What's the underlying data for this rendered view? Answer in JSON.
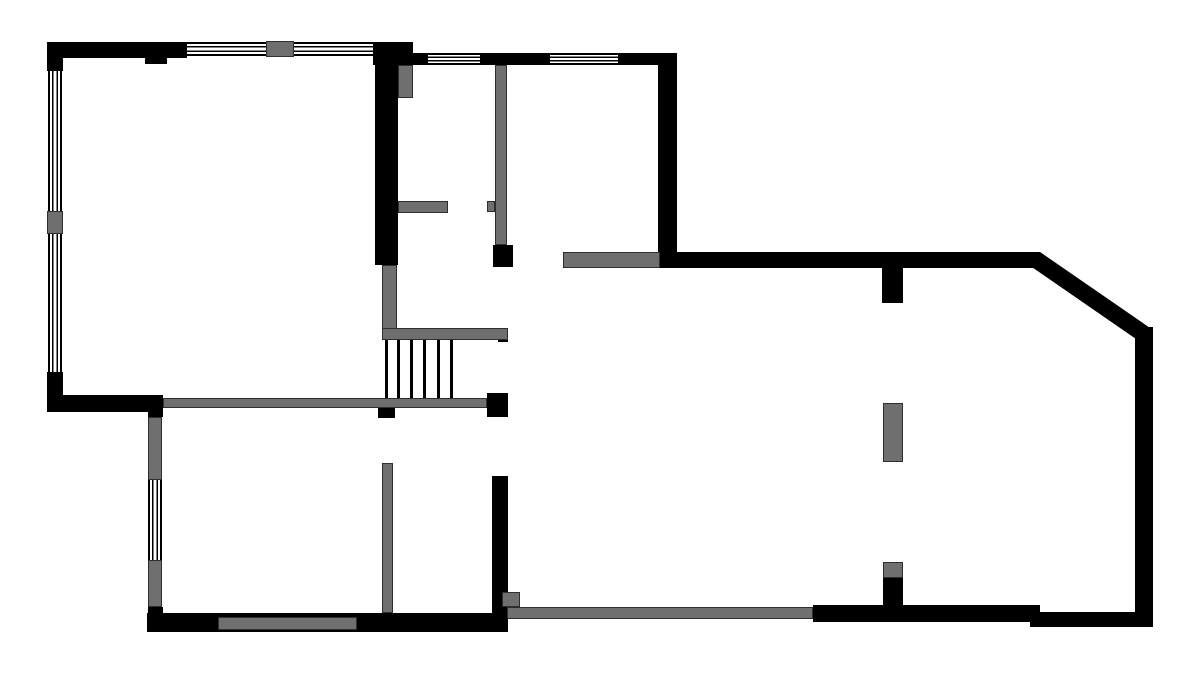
{
  "meta": {
    "title": "architectural-floor-plan",
    "canvas": {
      "width": 1200,
      "height": 683
    },
    "colors": {
      "wall": "#000000",
      "gray": "#6f6f6f",
      "gray_border": "#2e2e2e",
      "background": "#ffffff",
      "line": "#000000"
    }
  },
  "plan": {
    "walls": [
      {
        "name": "top-wall-left",
        "x": 47,
        "y": 42,
        "w": 140,
        "h": 16
      },
      {
        "name": "top-wall-left-notch",
        "x": 145,
        "y": 58,
        "w": 22,
        "h": 6
      },
      {
        "name": "left-wall-top-corner",
        "x": 47,
        "y": 42,
        "w": 16,
        "h": 29
      },
      {
        "name": "left-wall-bottom-corner",
        "x": 47,
        "y": 372,
        "w": 16,
        "h": 40
      },
      {
        "name": "livingroom-bottom-wall-black",
        "x": 47,
        "y": 395,
        "w": 116,
        "h": 17
      },
      {
        "name": "top-mid-corner-block",
        "x": 373,
        "y": 42,
        "w": 40,
        "h": 23
      },
      {
        "name": "mid-vertical-wall",
        "x": 375,
        "y": 65,
        "w": 23,
        "h": 200
      },
      {
        "name": "mid-top-wall-a",
        "x": 413,
        "y": 53,
        "w": 15,
        "h": 12
      },
      {
        "name": "mid-top-wall-b",
        "x": 480,
        "y": 53,
        "w": 70,
        "h": 12
      },
      {
        "name": "mid-top-wall-c",
        "x": 618,
        "y": 53,
        "w": 59,
        "h": 12
      },
      {
        "name": "mid-right-vertical-wall",
        "x": 658,
        "y": 53,
        "w": 19,
        "h": 215
      },
      {
        "name": "hall-wall-end-block",
        "x": 493,
        "y": 245,
        "w": 20,
        "h": 22
      },
      {
        "name": "stair-rail-end-notch",
        "x": 498,
        "y": 333,
        "w": 10,
        "h": 9
      },
      {
        "name": "stair-bottom-block",
        "x": 487,
        "y": 393,
        "w": 21,
        "h": 24
      },
      {
        "name": "hall-bottom-notch",
        "x": 378,
        "y": 408,
        "w": 17,
        "h": 10
      },
      {
        "name": "bottomleft-leftwall-top-block",
        "x": 148,
        "y": 405,
        "w": 15,
        "h": 12
      },
      {
        "name": "bottomleft-leftwall-bottom-block",
        "x": 148,
        "y": 607,
        "w": 15,
        "h": 25
      },
      {
        "name": "bottomleft-bottom-wall",
        "x": 147,
        "y": 613,
        "w": 360,
        "h": 19
      },
      {
        "name": "bottomleft-right-wall",
        "x": 492,
        "y": 476,
        "w": 16,
        "h": 156
      },
      {
        "name": "upper-horizontal-wall",
        "x": 658,
        "y": 252,
        "w": 382,
        "h": 16
      },
      {
        "name": "rightroom-top-stub",
        "x": 882,
        "y": 267,
        "w": 21,
        "h": 36
      },
      {
        "name": "right-wall",
        "x": 1135,
        "y": 327,
        "w": 18,
        "h": 300
      },
      {
        "name": "bottom-wall-right-seg",
        "x": 1030,
        "y": 612,
        "w": 123,
        "h": 15
      },
      {
        "name": "bottom-wall-mid-seg",
        "x": 813,
        "y": 605,
        "w": 227,
        "h": 17
      },
      {
        "name": "rightroom-pillar-connector",
        "x": 883,
        "y": 578,
        "w": 20,
        "h": 30
      }
    ],
    "gray_walls": [
      {
        "name": "top-window-divider",
        "x": 266,
        "y": 41,
        "w": 28,
        "h": 16
      },
      {
        "name": "left-window-divider",
        "x": 47,
        "y": 211,
        "w": 16,
        "h": 23
      },
      {
        "name": "entry-door-leaf",
        "x": 398,
        "y": 65,
        "w": 15,
        "h": 33
      },
      {
        "name": "hall-stub-wall",
        "x": 398,
        "y": 201,
        "w": 50,
        "h": 12
      },
      {
        "name": "hall-vertical-gray-wall",
        "x": 495,
        "y": 65,
        "w": 12,
        "h": 180
      },
      {
        "name": "hall-doorstop",
        "x": 487,
        "y": 201,
        "w": 8,
        "h": 11
      },
      {
        "name": "stair-side-wall",
        "x": 382,
        "y": 265,
        "w": 15,
        "h": 67
      },
      {
        "name": "stair-rail",
        "x": 382,
        "y": 328,
        "w": 126,
        "h": 12
      },
      {
        "name": "livingroom-bottom-wall-gray",
        "x": 163,
        "y": 398,
        "w": 324,
        "h": 10
      },
      {
        "name": "bottomleft-leftwall-gray-upper",
        "x": 148,
        "y": 417,
        "w": 14,
        "h": 63
      },
      {
        "name": "bottomleft-leftwall-gray-lower",
        "x": 148,
        "y": 560,
        "w": 14,
        "h": 47
      },
      {
        "name": "bottomleft-interior-wall",
        "x": 382,
        "y": 463,
        "w": 11,
        "h": 150
      },
      {
        "name": "bottomleft-bottom-opening",
        "x": 218,
        "y": 617,
        "w": 139,
        "h": 13
      },
      {
        "name": "passage-gray-square",
        "x": 502,
        "y": 592,
        "w": 18,
        "h": 15
      },
      {
        "name": "bottom-sliding-track",
        "x": 507,
        "y": 607,
        "w": 306,
        "h": 12
      },
      {
        "name": "upper-gray-wall",
        "x": 563,
        "y": 252,
        "w": 97,
        "h": 16
      },
      {
        "name": "rightroom-pillar",
        "x": 883,
        "y": 403,
        "w": 20,
        "h": 59
      },
      {
        "name": "rightroom-pillar-small",
        "x": 883,
        "y": 562,
        "w": 20,
        "h": 16
      }
    ],
    "windows_h": [
      {
        "name": "top-window-a",
        "x": 187,
        "y": 42,
        "w": 79,
        "h": 14
      },
      {
        "name": "top-window-b",
        "x": 294,
        "y": 42,
        "w": 79,
        "h": 14
      },
      {
        "name": "mid-top-window-a",
        "x": 428,
        "y": 53,
        "w": 52,
        "h": 12
      },
      {
        "name": "mid-top-window-b",
        "x": 550,
        "y": 53,
        "w": 68,
        "h": 12
      }
    ],
    "windows_v": [
      {
        "name": "left-window-upper",
        "x": 48,
        "y": 71,
        "w": 14,
        "h": 140
      },
      {
        "name": "left-window-lower",
        "x": 48,
        "y": 234,
        "w": 14,
        "h": 138
      },
      {
        "name": "bottomleft-window",
        "x": 148,
        "y": 480,
        "w": 14,
        "h": 80
      }
    ],
    "stairs": {
      "name": "staircase",
      "y": 340,
      "line_height": 58,
      "line_width": 3,
      "line_xs": [
        385,
        397,
        410,
        423,
        437,
        450
      ]
    },
    "diagonal": {
      "name": "diagonal-wall",
      "x1": 1040,
      "y1": 252,
      "x2": 1153,
      "y2": 330,
      "thickness": 17
    }
  }
}
